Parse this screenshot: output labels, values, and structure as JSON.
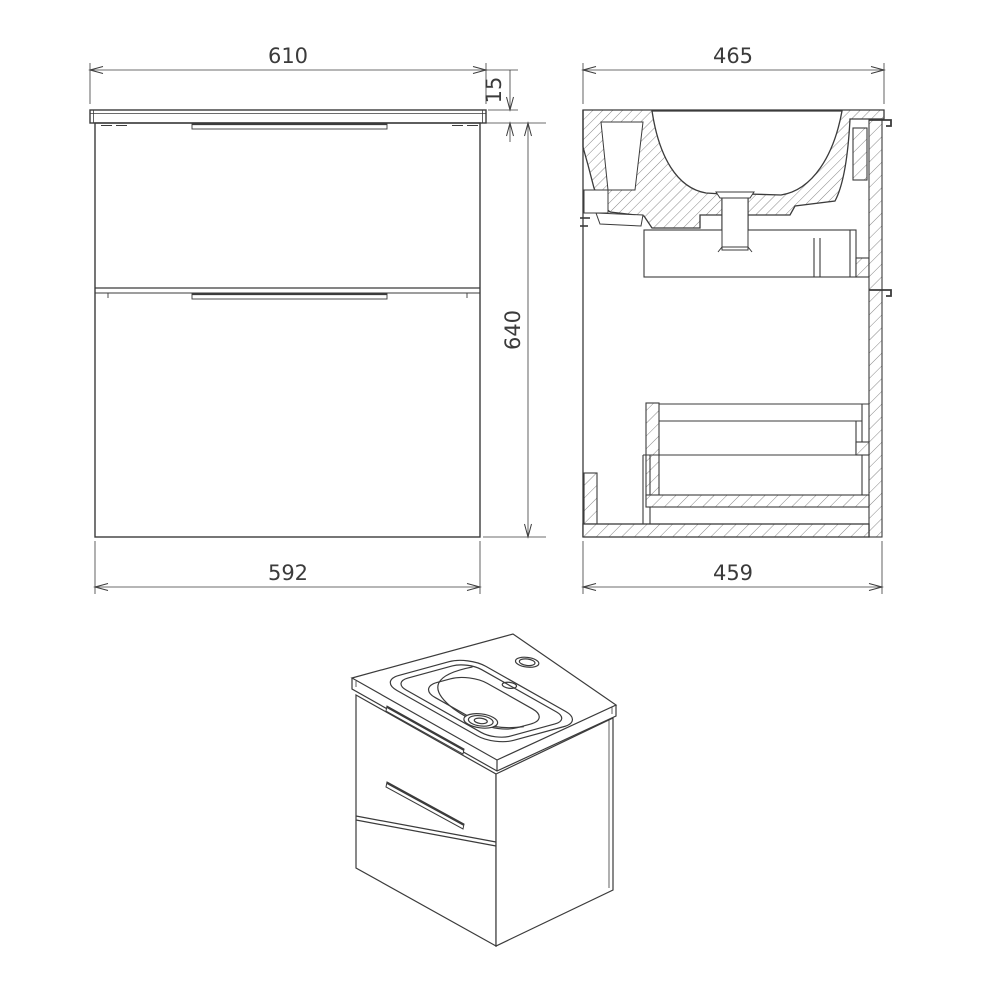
{
  "drawing": {
    "background": "#ffffff",
    "line_color": "#3b3b3b",
    "views": {
      "front_elevation": {
        "dimensions": {
          "countertop_width": "610",
          "countertop_thickness": "15",
          "cabinet_height": "640",
          "cabinet_width": "592"
        }
      },
      "side_section": {
        "dimensions": {
          "countertop_depth": "465",
          "cabinet_depth": "459"
        }
      }
    }
  }
}
